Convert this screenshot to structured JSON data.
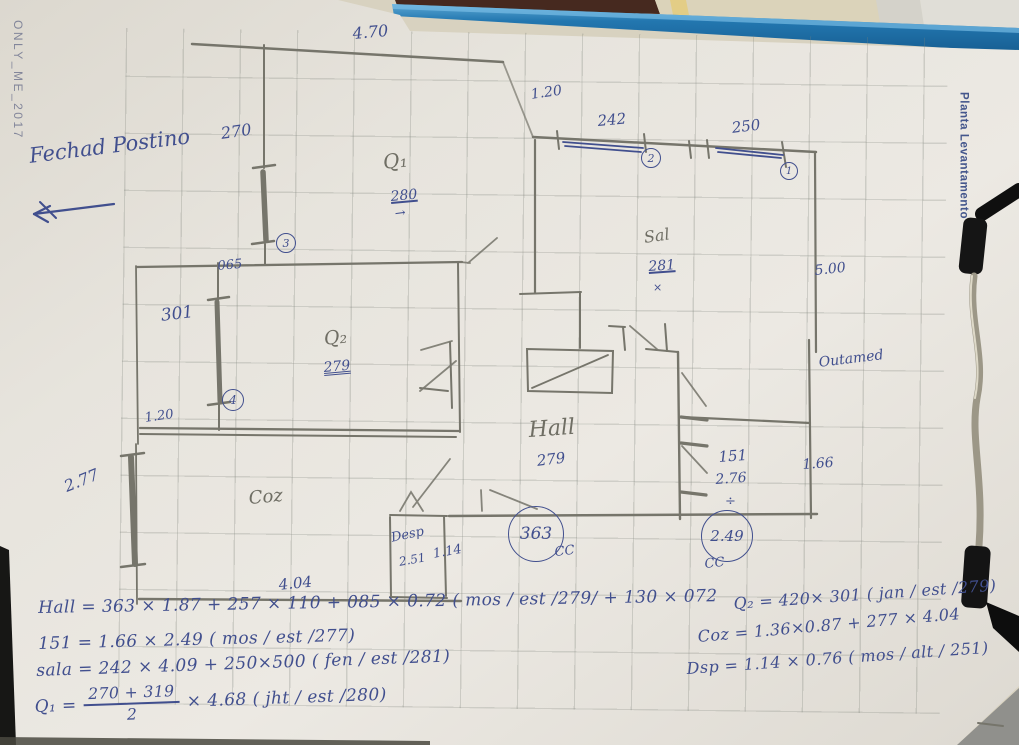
{
  "photo": {
    "watermark": "ONLY_ME_2017",
    "side_label": "Planta Levantamento"
  },
  "colors": {
    "ink": "#414f8e",
    "pencil": "#6f6e64",
    "board_blue": "#2377b0"
  },
  "sketch": {
    "labels": [
      {
        "text": "Fechad Postino",
        "x": 28,
        "y": 146,
        "size": 21,
        "rot": -7,
        "kind": "ink"
      },
      {
        "text": "4.70",
        "x": 352,
        "y": 26,
        "size": 16,
        "rot": -5,
        "kind": "ink"
      },
      {
        "text": "270",
        "x": 220,
        "y": 126,
        "size": 16,
        "rot": -8,
        "kind": "ink"
      },
      {
        "text": "1.20",
        "x": 530,
        "y": 88,
        "size": 14,
        "rot": -8,
        "kind": "ink"
      },
      {
        "text": "242",
        "x": 597,
        "y": 114,
        "size": 15,
        "rot": -5,
        "kind": "ink"
      },
      {
        "text": "250",
        "x": 731,
        "y": 121,
        "size": 15,
        "rot": -7,
        "kind": "ink"
      },
      {
        "text": "065",
        "x": 217,
        "y": 260,
        "size": 13,
        "rot": -5,
        "kind": "ink"
      },
      {
        "text": "301",
        "x": 160,
        "y": 308,
        "size": 17,
        "rot": -7,
        "kind": "ink"
      },
      {
        "text": "1.20",
        "x": 144,
        "y": 412,
        "size": 13,
        "rot": -8,
        "kind": "ink"
      },
      {
        "text": "2.77",
        "x": 62,
        "y": 480,
        "size": 16,
        "rot": -22,
        "kind": "ink"
      },
      {
        "text": "4.04",
        "x": 278,
        "y": 578,
        "size": 15,
        "rot": -6,
        "kind": "ink"
      },
      {
        "text": "Q₁",
        "x": 382,
        "y": 152,
        "size": 20,
        "rot": -6,
        "kind": "pencil"
      },
      {
        "text": "280",
        "x": 390,
        "y": 190,
        "size": 14,
        "rot": -5,
        "kind": "ink",
        "u": 1
      },
      {
        "text": "→",
        "x": 394,
        "y": 208,
        "size": 13,
        "rot": -8,
        "kind": "ink"
      },
      {
        "text": "Q₂",
        "x": 323,
        "y": 330,
        "size": 19,
        "rot": -6,
        "kind": "pencil"
      },
      {
        "text": "279",
        "x": 323,
        "y": 361,
        "size": 14,
        "rot": -5,
        "kind": "ink",
        "u": 2
      },
      {
        "text": "Sal",
        "x": 643,
        "y": 230,
        "size": 16,
        "rot": -8,
        "kind": "pencil"
      },
      {
        "text": "281",
        "x": 648,
        "y": 260,
        "size": 14,
        "rot": -4,
        "kind": "ink",
        "u": 1
      },
      {
        "text": "×",
        "x": 653,
        "y": 282,
        "size": 11,
        "rot": 0,
        "kind": "ink"
      },
      {
        "text": "5.00",
        "x": 814,
        "y": 264,
        "size": 14,
        "rot": -6,
        "kind": "ink"
      },
      {
        "text": "Outamed",
        "x": 818,
        "y": 356,
        "size": 14,
        "rot": -7,
        "kind": "ink"
      },
      {
        "text": "Hall",
        "x": 528,
        "y": 420,
        "size": 22,
        "rot": -4,
        "kind": "pencil"
      },
      {
        "text": "279",
        "x": 536,
        "y": 454,
        "size": 15,
        "rot": -7,
        "kind": "ink"
      },
      {
        "text": "151",
        "x": 718,
        "y": 450,
        "size": 15,
        "rot": -4,
        "kind": "ink"
      },
      {
        "text": "2.76",
        "x": 715,
        "y": 473,
        "size": 14,
        "rot": -4,
        "kind": "ink"
      },
      {
        "text": "÷",
        "x": 725,
        "y": 495,
        "size": 13,
        "rot": 0,
        "kind": "ink"
      },
      {
        "text": "1.66",
        "x": 802,
        "y": 458,
        "size": 14,
        "rot": -4,
        "kind": "ink"
      },
      {
        "text": "Coz",
        "x": 248,
        "y": 490,
        "size": 18,
        "rot": -5,
        "kind": "pencil"
      },
      {
        "text": "Desp",
        "x": 390,
        "y": 532,
        "size": 13,
        "rot": -12,
        "kind": "ink"
      },
      {
        "text": "2.51",
        "x": 398,
        "y": 556,
        "size": 12,
        "rot": -10,
        "kind": "ink"
      },
      {
        "text": "1.14",
        "x": 432,
        "y": 548,
        "size": 13,
        "rot": -10,
        "kind": "ink"
      },
      {
        "text": "CC",
        "x": 554,
        "y": 546,
        "size": 13,
        "rot": -6,
        "kind": "ink"
      },
      {
        "text": "CC",
        "x": 704,
        "y": 558,
        "size": 13,
        "rot": -6,
        "kind": "ink"
      }
    ],
    "circles": [
      {
        "text": "2",
        "x": 651,
        "y": 158,
        "r": 10,
        "fs": 11
      },
      {
        "text": "1",
        "x": 789,
        "y": 171,
        "r": 9,
        "fs": 10
      },
      {
        "text": "3",
        "x": 286,
        "y": 243,
        "r": 10,
        "fs": 11
      },
      {
        "text": "4",
        "x": 233,
        "y": 400,
        "r": 11,
        "fs": 12
      },
      {
        "text": "363",
        "x": 536,
        "y": 534,
        "r": 28,
        "fs": 17
      },
      {
        "text": "2.49",
        "x": 727,
        "y": 536,
        "r": 26,
        "fs": 15
      }
    ],
    "equations": [
      {
        "text": "Hall = 363 × 1.87 + 257 × 110 + 085 × 0.72 ( mos / est /279/ + 130 × 072",
        "x": 38,
        "y": 598,
        "size": 17,
        "rot": -1
      },
      {
        "text": "151 = 1.66 × 2.49 ( mos / est /277)",
        "x": 38,
        "y": 634,
        "size": 17,
        "rot": -1.5
      },
      {
        "text": "sala = 242 × 4.09 + 250×500 ( fen / est /281)",
        "x": 36,
        "y": 661,
        "size": 17,
        "rot": -2
      },
      {
        "pre": "Q₁ = ",
        "frac_num": "270 + 319",
        "frac_den": "2",
        "post": " × 4.68   ( jht / est /280)",
        "x": 34,
        "y": 688,
        "size": 17,
        "rot": -2
      },
      {
        "text": "Q₂ = 420× 301 ( jan / est /279)",
        "x": 733,
        "y": 594,
        "size": 16,
        "rot": -4
      },
      {
        "text": "Coz = 1.36×0.87 + 277 × 4.04",
        "x": 697,
        "y": 627,
        "size": 16,
        "rot": -5
      },
      {
        "text": "Dsp = 1.14 × 0.76 ( mos / alt / 251)",
        "x": 686,
        "y": 659,
        "size": 16,
        "rot": -4
      }
    ]
  }
}
